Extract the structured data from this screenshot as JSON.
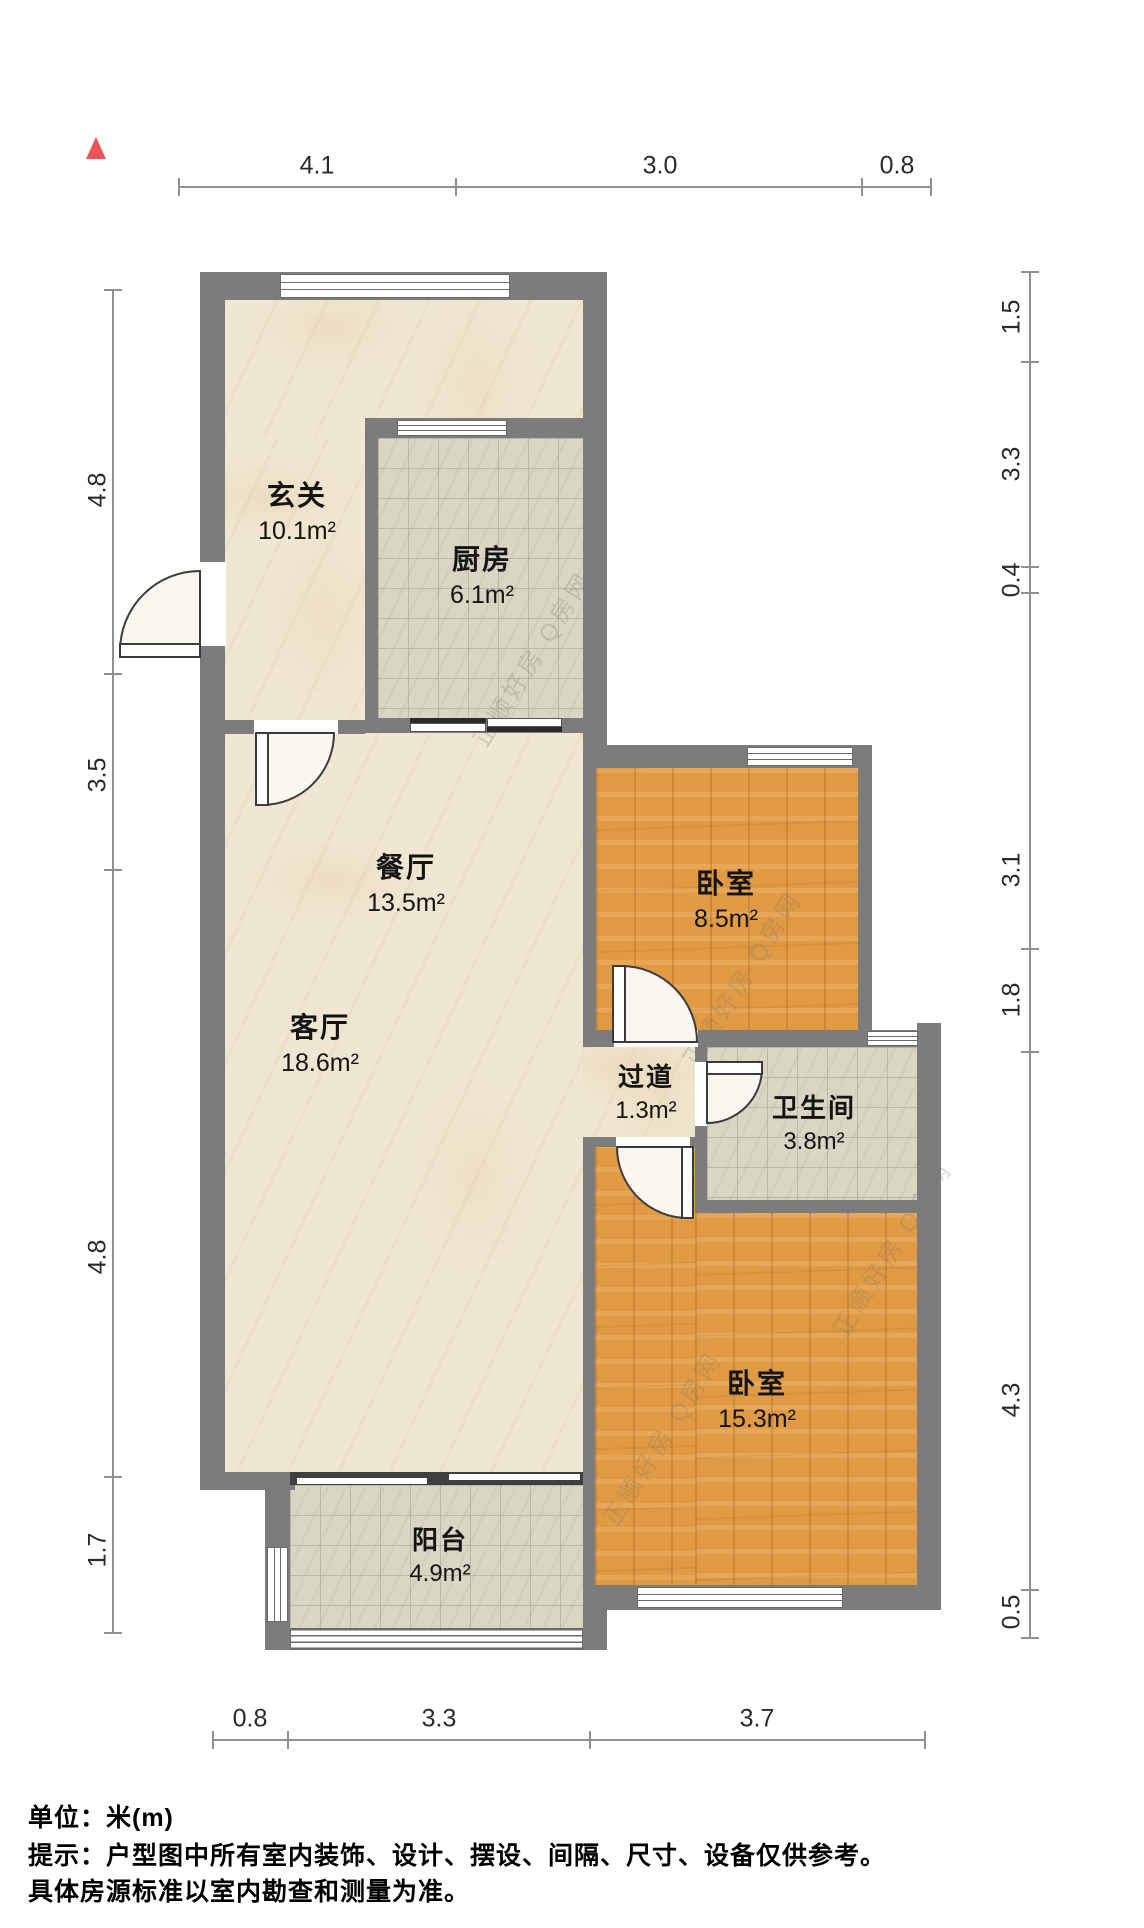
{
  "plan": {
    "units_note": "单位：米(m)",
    "disclaimer_line1": "提示：户型图中所有室内装饰、设计、摆设、间隔、尺寸、设备仅供参考。",
    "disclaimer_line2": "具体房源标准以室内勘查和测量为准。",
    "watermark": "正顺好房 Q房网",
    "north_color": "#e85458",
    "wall_color": "#7c7c7c",
    "balcony_wall_color": "#3f3f3f",
    "wood_color": "#e09a44",
    "tile_color": "#d9d6c4",
    "marble_color": "#f0e7d2"
  },
  "rooms": [
    {
      "name": "玄关",
      "area": "10.1m²"
    },
    {
      "name": "厨房",
      "area": "6.1m²"
    },
    {
      "name": "餐厅",
      "area": "13.5m²"
    },
    {
      "name": "卧室",
      "area": "8.5m²"
    },
    {
      "name": "过道",
      "area": "1.3m²"
    },
    {
      "name": "卫生间",
      "area": "3.8m²"
    },
    {
      "name": "客厅",
      "area": "18.6m²"
    },
    {
      "name": "卧室",
      "area": "15.3m²"
    },
    {
      "name": "阳台",
      "area": "4.9m²"
    }
  ],
  "dims": {
    "top": [
      "4.1",
      "3.0",
      "0.8"
    ],
    "bottom": [
      "0.8",
      "3.3",
      "3.7"
    ],
    "left": [
      "4.8",
      "3.5",
      "4.8",
      "1.7"
    ],
    "right": [
      "1.5",
      "3.3",
      "0.4",
      "3.1",
      "1.8",
      "4.3",
      "0.5"
    ]
  }
}
